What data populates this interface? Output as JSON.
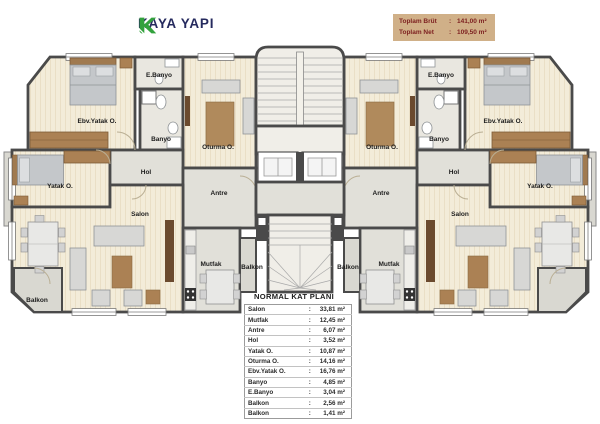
{
  "brand": {
    "name": "KAYA YAPI"
  },
  "summary": {
    "rows": [
      {
        "label": "Toplam Brüt",
        "sep": ":",
        "value": "141,00 m²"
      },
      {
        "label": "Toplam Net",
        "sep": ":",
        "value": "109,50 m²"
      }
    ]
  },
  "rooms": {
    "ebv_yatak": "Ebv.Yatak O.",
    "e_banyo": "E.Banyo",
    "banyo": "Banyo",
    "oturma": "Oturma O.",
    "yatak": "Yatak O.",
    "hol": "Hol",
    "antre": "Antre",
    "salon": "Salon",
    "mutfak": "Mutfak",
    "balkon": "Balkon"
  },
  "table": {
    "title": "NORMAL KAT PLANI",
    "rows": [
      {
        "name": "Salon",
        "sep": ":",
        "value": "33,81 m²"
      },
      {
        "name": "Mutfak",
        "sep": ":",
        "value": "12,45 m²"
      },
      {
        "name": "Antre",
        "sep": ":",
        "value": "6,07 m²"
      },
      {
        "name": "Hol",
        "sep": ":",
        "value": "3,52 m²"
      },
      {
        "name": "Yatak O.",
        "sep": ":",
        "value": "10,87 m²"
      },
      {
        "name": "Oturma O.",
        "sep": ":",
        "value": "14,16 m²"
      },
      {
        "name": "Ebv.Yatak O.",
        "sep": ":",
        "value": "16,76 m²"
      },
      {
        "name": "Banyo",
        "sep": ":",
        "value": "4,85 m²"
      },
      {
        "name": "E.Banyo",
        "sep": ":",
        "value": "3,04 m²"
      },
      {
        "name": "Balkon",
        "sep": ":",
        "value": "2,56 m²"
      },
      {
        "name": "Balkon",
        "sep": ":",
        "value": "1,41 m²"
      }
    ]
  },
  "colors": {
    "logo_green": "#33a23d",
    "brand_navy": "#252a5e",
    "summary_bg": "#d0b088",
    "summary_text": "#7c1f1f",
    "wall": "#4a4a4a",
    "floor_cream": "#f3ecd9",
    "floor_gray": "#e1e0d9",
    "furniture_brown": "#ab8154"
  }
}
